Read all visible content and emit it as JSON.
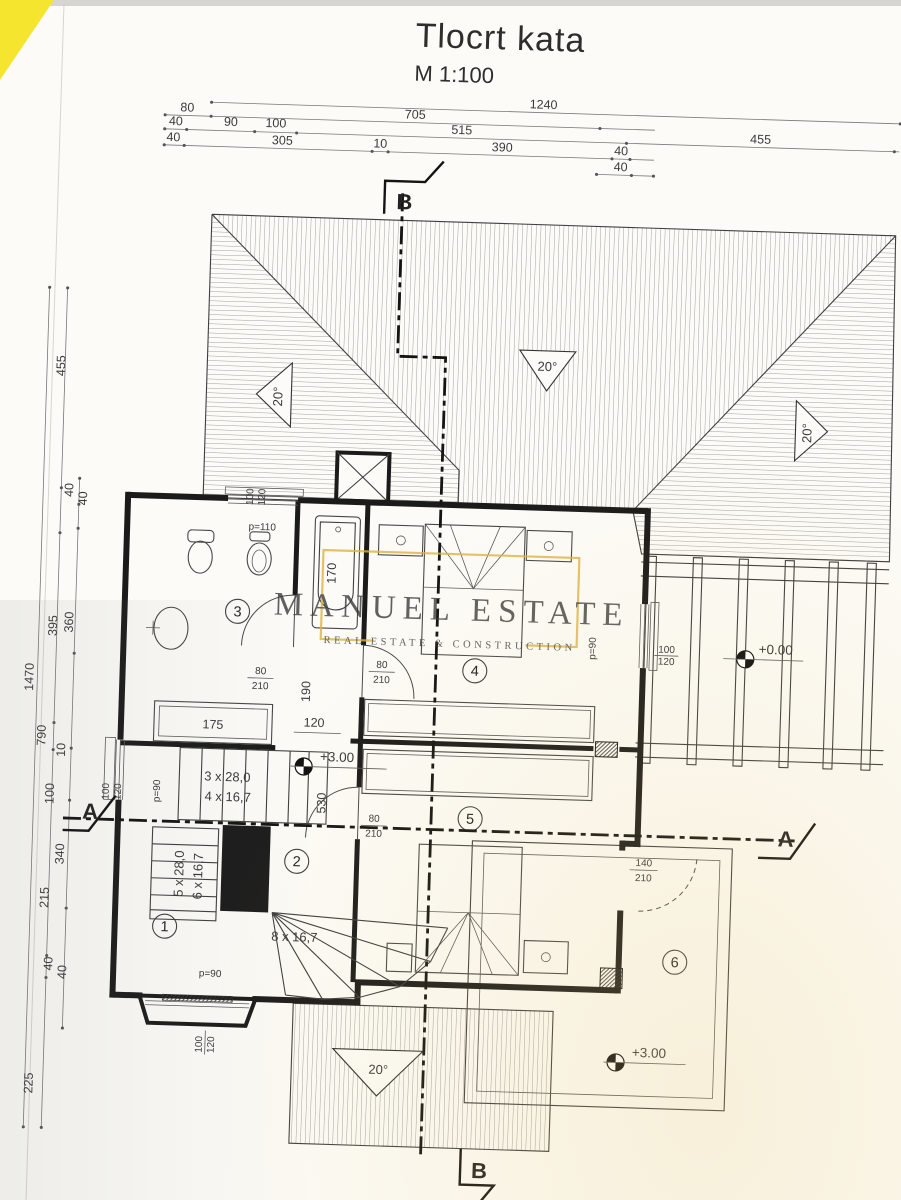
{
  "title": {
    "main": "Tlocrt kata",
    "scale": "M 1:100"
  },
  "watermark": {
    "name": "MANUEL ESTATE",
    "tagline": "REAL ESTATE & CONSTRUCTION"
  },
  "colors": {
    "gold": "#ddb345",
    "corner_highlight": "#f6e52e"
  },
  "top_dims": {
    "row0": [
      "1240"
    ],
    "row1": [
      "80",
      "705"
    ],
    "row2": [
      "40",
      "90",
      "100",
      "515",
      "455"
    ],
    "row3": [
      "40",
      "305",
      "10",
      "390",
      "40"
    ],
    "row4": [
      "40"
    ]
  },
  "left_dims": {
    "outer": "1470",
    "chain": [
      "455",
      "40",
      "40",
      "395",
      "360",
      "790",
      "10",
      "100",
      "340",
      "215",
      "40",
      "40",
      "225"
    ]
  },
  "interior_dims": {
    "tub": "170",
    "closet": "175",
    "w120": "120",
    "w190": "190",
    "w530": "530"
  },
  "stairs": {
    "run1a": "3 x 28,0",
    "run1b": "4 x 16,7",
    "run2a": "5 x 28,0",
    "run2b": "6 x 16,7",
    "run3": "8 x 16,7"
  },
  "doors": {
    "interior_w": "80",
    "interior_h": "210",
    "terrace_w": "140",
    "terrace_h": "210"
  },
  "windows": {
    "sill90": "p=90",
    "sill110": "p=110",
    "w": "100",
    "h": "120"
  },
  "levels": {
    "floor": "+3.00",
    "ground": "+0.00"
  },
  "rooms": [
    "1",
    "2",
    "3",
    "4",
    "5",
    "6"
  ],
  "roof": {
    "slope": "20°"
  },
  "sections": {
    "a": "A",
    "b": "B"
  },
  "edge_cut_dims": [
    "150",
    "45"
  ]
}
